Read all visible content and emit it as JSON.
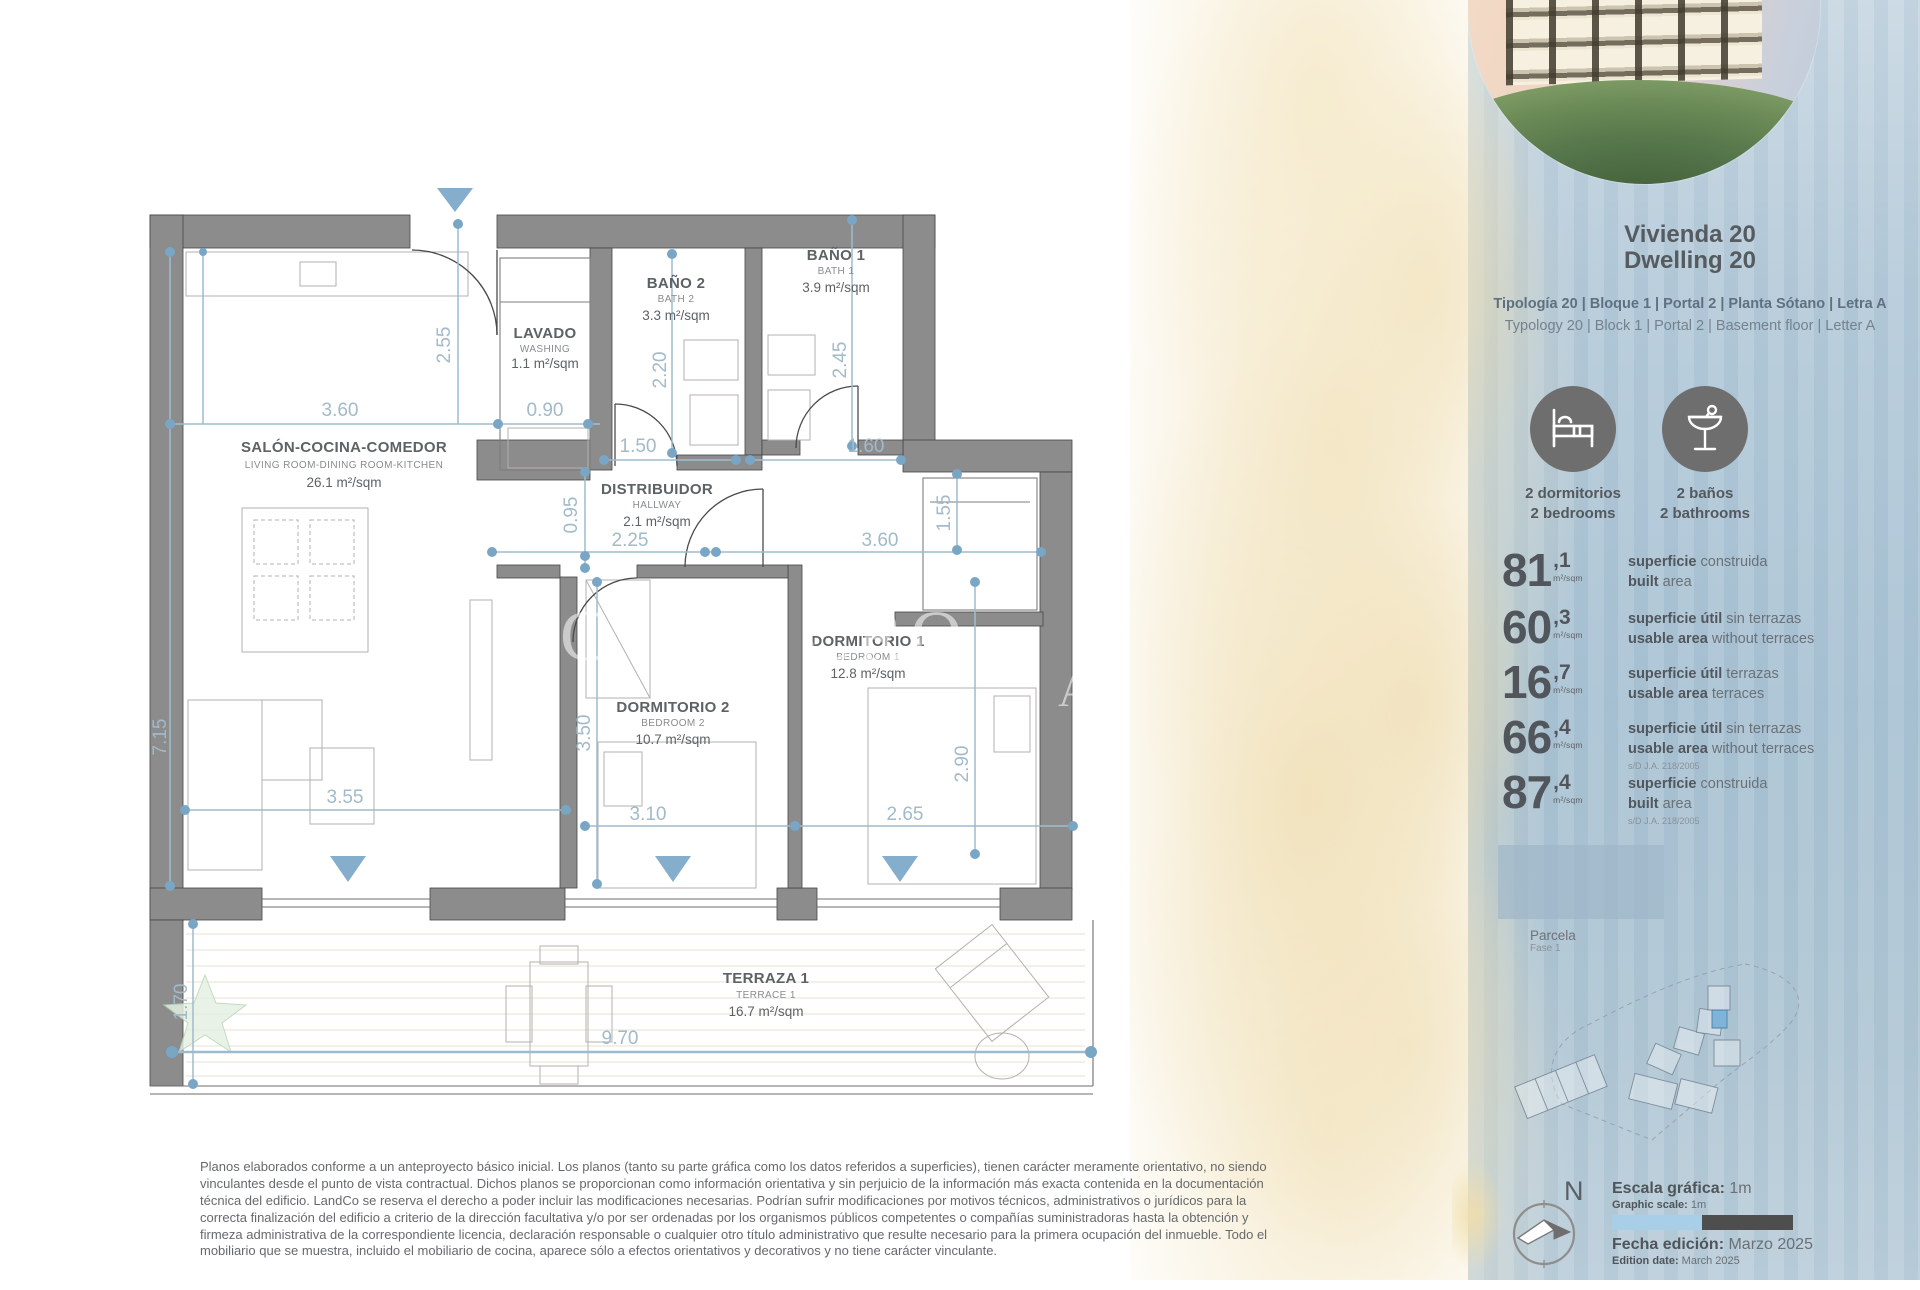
{
  "watermark": {
    "line1": "C' L A CRO",
    "line2": "A"
  },
  "plan": {
    "rooms": [
      {
        "name": "SALÓN-COCINA-COMEDOR",
        "sub": "LIVING ROOM-DINING ROOM-KITCHEN",
        "area": "26.1 m²/sqm"
      },
      {
        "name": "LAVADO",
        "sub": "WASHING",
        "area": "1.1 m²/sqm"
      },
      {
        "name": "BAÑO 2",
        "sub": "BATH 2",
        "area": "3.3 m²/sqm"
      },
      {
        "name": "BAÑO 1",
        "sub": "BATH 1",
        "area": "3.9 m²/sqm"
      },
      {
        "name": "DISTRIBUIDOR",
        "sub": "HALLWAY",
        "area": "2.1 m²/sqm"
      },
      {
        "name": "DORMITORIO 1",
        "sub": "BEDROOM 1",
        "area": "12.8 m²/sqm"
      },
      {
        "name": "DORMITORIO 2",
        "sub": "BEDROOM 2",
        "area": "10.7 m²/sqm"
      },
      {
        "name": "TERRAZA 1",
        "sub": "TERRACE 1",
        "area": "16.7 m²/sqm"
      }
    ],
    "dims": [
      "7.15",
      "3.60",
      "0.90",
      "2.55",
      "2.20",
      "2.45",
      "1.50",
      "1.60",
      "0.95",
      "2.25",
      "3.60",
      "1.55",
      "3.50",
      "2.90",
      "3.10",
      "2.65",
      "3.55",
      "1.70",
      "9.70"
    ]
  },
  "sidebar": {
    "title_es": "Vivienda 20",
    "title_en": "Dwelling 20",
    "typology_es": "Tipología 20  |  Bloque 1  |  Portal 2  |  Planta Sótano  |  Letra A",
    "typology_en": "Typology 20  |  Block 1  |  Portal 2  |  Basement floor  |  Letter A",
    "features": [
      {
        "label_es": "2 dormitorios",
        "label_en": "2 bedrooms",
        "icon": "bed-icon"
      },
      {
        "label_es": "2 baños",
        "label_en": "2 bathrooms",
        "icon": "cocktail-icon"
      }
    ],
    "stats": [
      {
        "value": "81",
        "decimal": ",1",
        "unit": "m²/sqm",
        "es_bold": "superficie",
        "es_rest": " construida",
        "en_bold": "built",
        "en_rest": " area",
        "note": ""
      },
      {
        "value": "60",
        "decimal": ",3",
        "unit": "m²/sqm",
        "es_bold": "superficie útil",
        "es_rest": " sin terrazas",
        "en_bold": "usable area",
        "en_rest": " without terraces",
        "note": ""
      },
      {
        "value": "16",
        "decimal": ",7",
        "unit": "m²/sqm",
        "es_bold": "superficie útil",
        "es_rest": " terrazas",
        "en_bold": "usable area",
        "en_rest": " terraces",
        "note": ""
      },
      {
        "value": "66",
        "decimal": ",4",
        "unit": "m²/sqm",
        "es_bold": "superficie útil",
        "es_rest": " sin terrazas",
        "en_bold": "usable area",
        "en_rest": " without terraces",
        "note": "s/D J.A. 218/2005"
      },
      {
        "value": "87",
        "decimal": ",4",
        "unit": "m²/sqm",
        "es_bold": "superficie",
        "es_rest": " construida",
        "en_bold": "built",
        "en_rest": " area",
        "note": "s/D J.A. 218/2005"
      }
    ],
    "parcela": {
      "label": "Parcela",
      "sub": "Fase 1"
    },
    "compass": "N",
    "scale": {
      "label_es": "Escala gráfica:",
      "value_es": " 1m",
      "label_en": "Graphic scale:",
      "value_en": " 1m"
    },
    "edition": {
      "label_es": "Fecha edición:",
      "value_es": " Marzo 2025",
      "label_en": "Edition date:",
      "value_en": " March 2025"
    }
  },
  "disclaimer": "Planos elaborados conforme a un anteproyecto básico inicial. Los planos (tanto su parte gráfica como los datos referidos a superficies), tienen carácter meramente orientativo, no siendo vinculantes desde el punto de vista contractual. Dichos planos se proporcionan como información orientativa y sin perjuicio de la información más exacta contenida en la documentación técnica del edificio. LandCo se reserva el derecho a poder incluir las modificaciones necesarias. Podrían sufrir modificaciones por motivos técnicos, administrativos o jurídicos para la correcta finalización del edificio a criterio de la dirección facultativa y/o por ser ordenadas por los organismos públicos competentes o compañías suministradoras hasta la obtención y firmeza administrativa de la correspondiente licencia, declaración responsable o cualquier otro título administrativo que resulte necesario para la primera ocupación del inmueble. Todo el mobiliario que se muestra, incluido el mobiliario de cocina, aparece sólo a efectos orientativos y decorativos y no tiene carácter vinculante.",
  "colors": {
    "accent_blue": "#8fb5ce",
    "wall_gray": "#8c8c8c",
    "panel_blue": "#aec6d6",
    "sand": "#f0e2bf",
    "icon_gray": "#6e6e6e",
    "scale_light": "#a9cfe8",
    "scale_dark": "#4e4e4e",
    "highlight_unit": "#7fb3d9"
  }
}
